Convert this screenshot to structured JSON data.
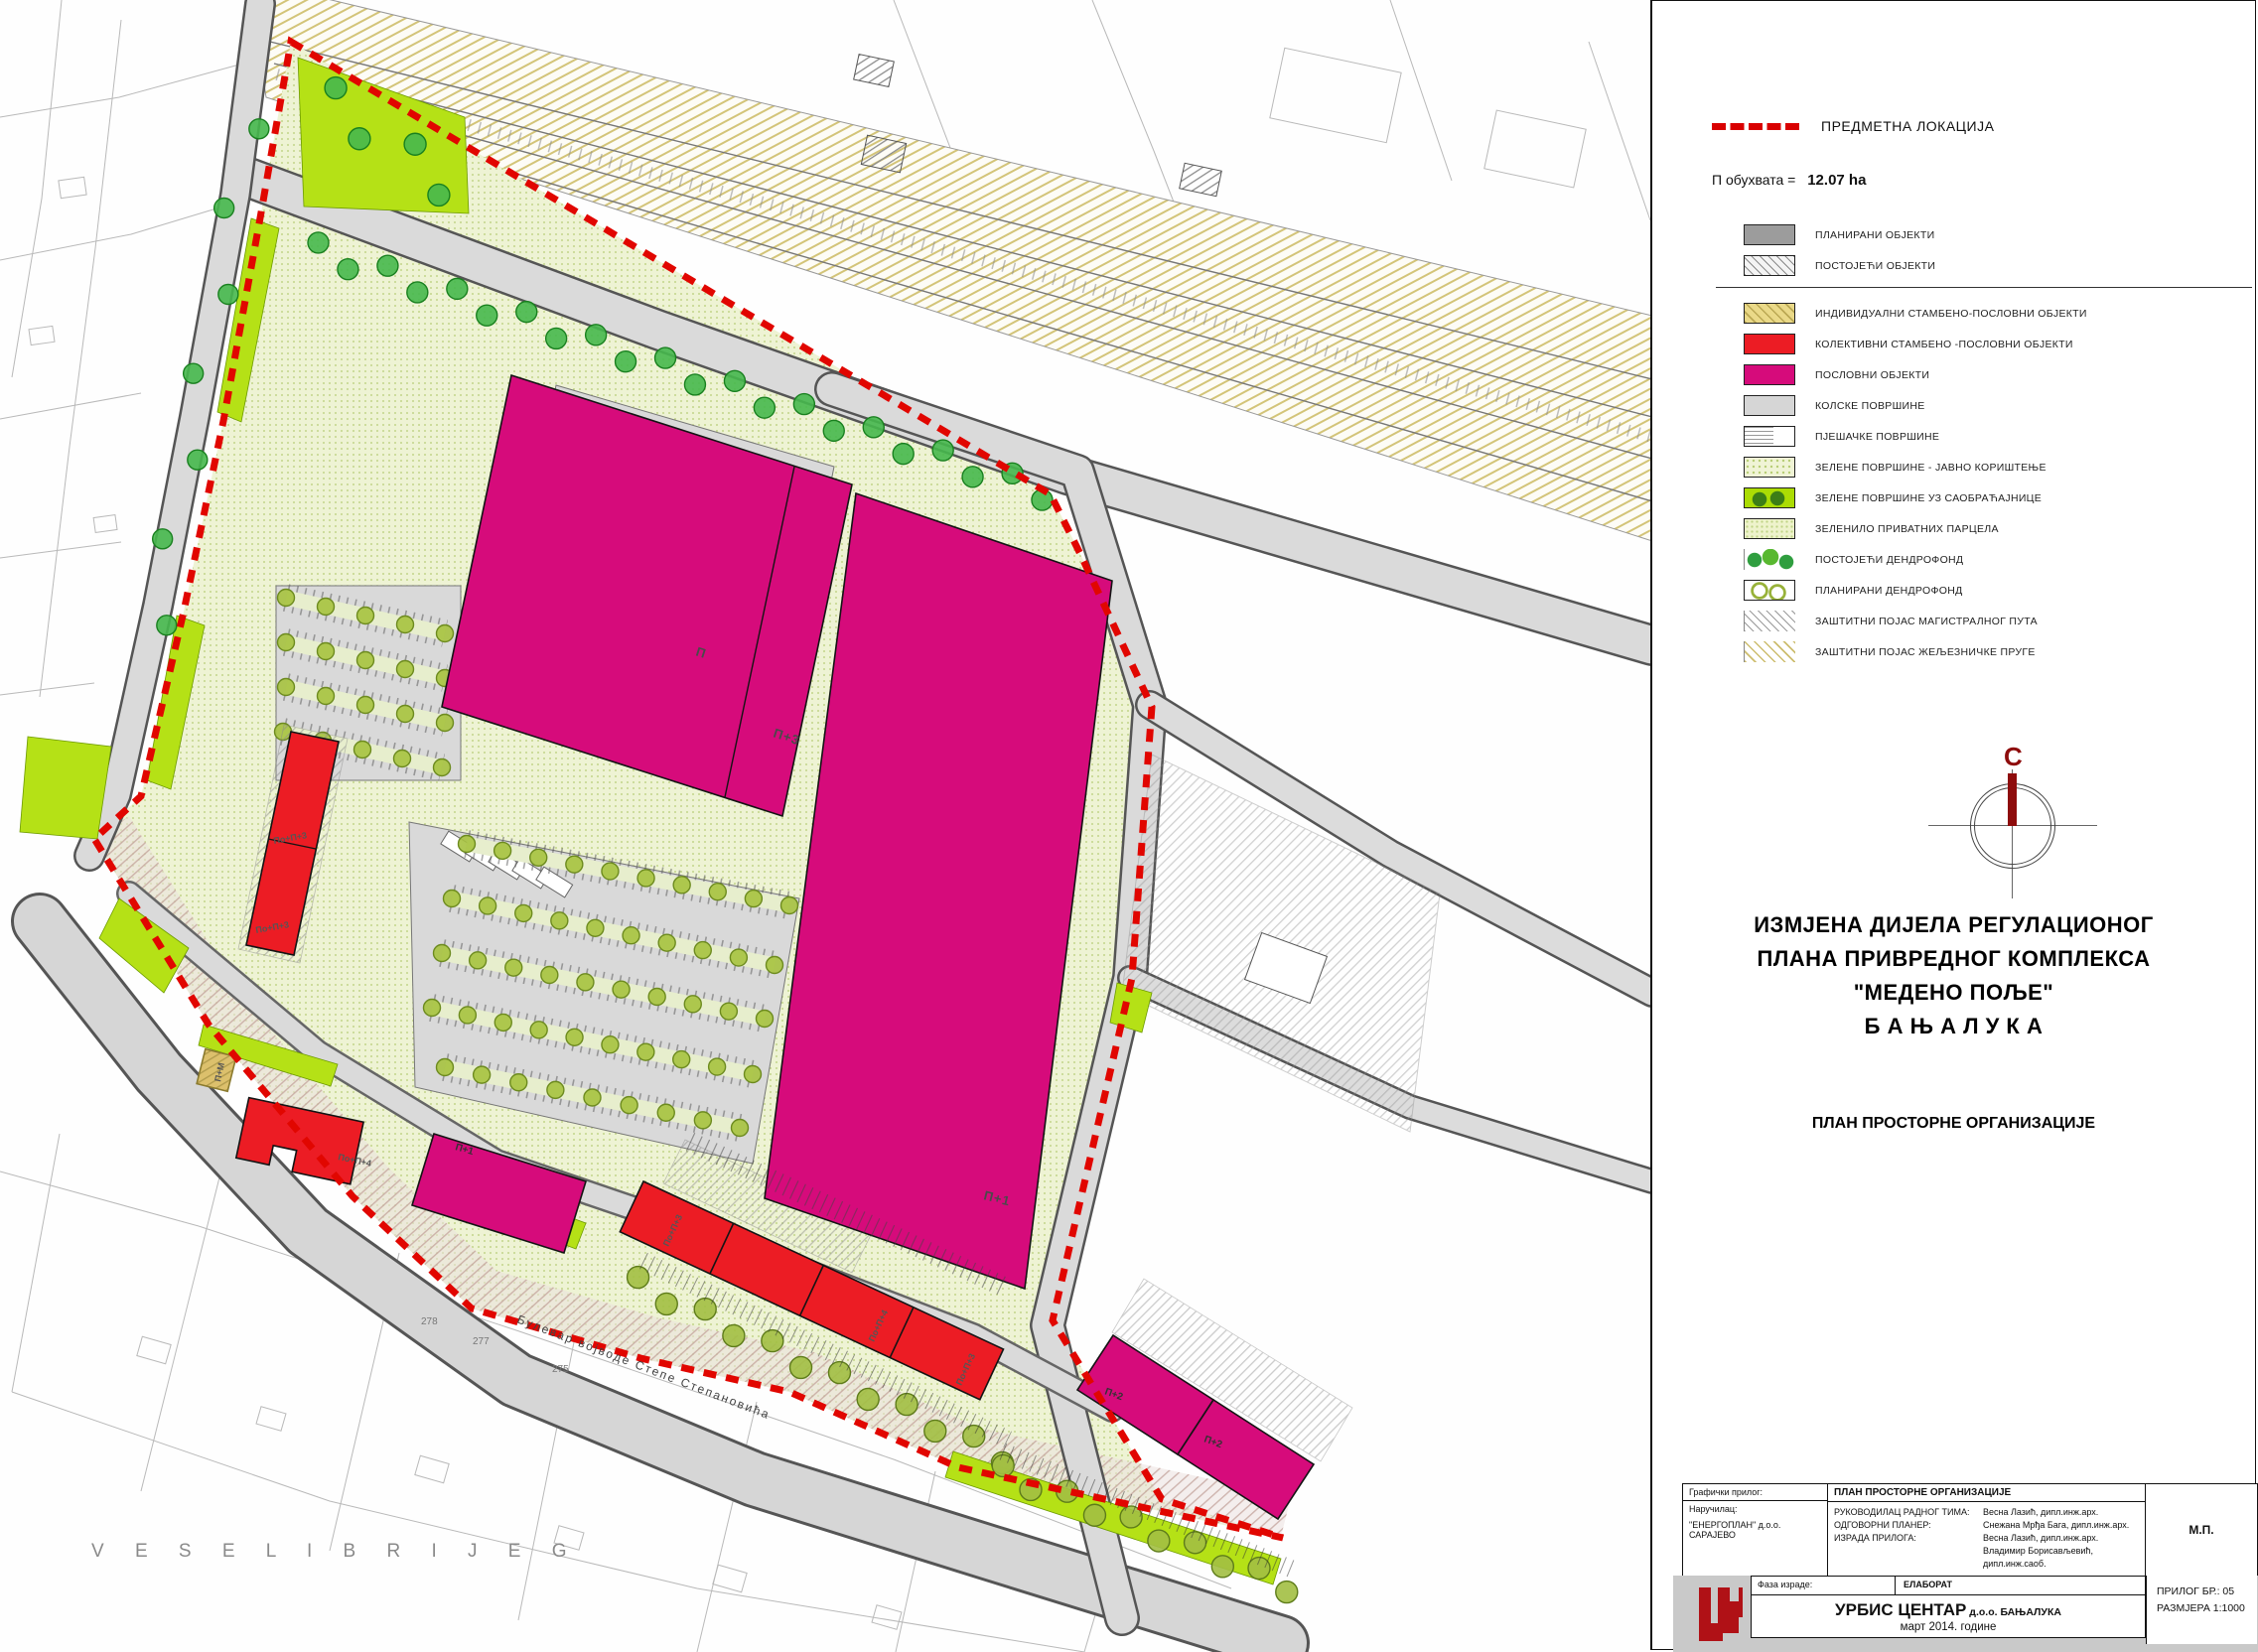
{
  "legend": {
    "location_label": "ПРЕДМЕТНА ЛОКАЦИЈА",
    "area_label": "П обухвата =",
    "area_value": "12.07 ha",
    "items": [
      {
        "key": "planned",
        "label": "ПЛАНИРАНИ ОБЈЕКТИ"
      },
      {
        "key": "existing",
        "label": "ПОСТОЈЕЋИ ОБЈЕКТИ"
      },
      {
        "key": "individual",
        "label": "ИНДИВИДУАЛНИ СТАМБЕНО-ПОСЛОВНИ ОБЈЕКТИ"
      },
      {
        "key": "collective",
        "label": "КОЛЕКТИВНИ СТАМБЕНО -ПОСЛОВНИ ОБЈЕКТИ"
      },
      {
        "key": "business",
        "label": "ПОСЛОВНИ ОБЈЕКТИ"
      },
      {
        "key": "vehicular",
        "label": "КОЛСКЕ ПОВРШИНЕ"
      },
      {
        "key": "pedestrian",
        "label": "ПЈЕШАЧКЕ ПОВРШИНЕ"
      },
      {
        "key": "green-public",
        "label": "ЗЕЛЕНЕ ПОВРШИНЕ  - ЈАВНО КОРИШТЕЊЕ"
      },
      {
        "key": "green-road",
        "label": "ЗЕЛЕНЕ ПОВРШИНЕ УЗ САОБРАЋАЈНИЦЕ"
      },
      {
        "key": "green-private",
        "label": "ЗЕЛЕНИЛО ПРИВАТНИХ ПАРЦЕЛА"
      },
      {
        "key": "dendro-existing",
        "label": "ПОСТОЈЕЋИ ДЕНДРОФОНД"
      },
      {
        "key": "dendro-planned",
        "label": "ПЛАНИРАНИ ДЕНДРОФОНД"
      },
      {
        "key": "belt-road",
        "label": "ЗАШТИТНИ ПОЈАС МАГИСТРАЛНОГ ПУТА"
      },
      {
        "key": "belt-rail",
        "label": "ЗАШТИТНИ ПОЈАС ЖЕЉЕЗНИЧКЕ ПРУГЕ"
      }
    ]
  },
  "compass": {
    "north": "С"
  },
  "titles": {
    "line1": "ИЗМЈЕНА ДИЈЕЛА РЕГУЛАЦИОНОГ",
    "line2": "ПЛАНА ПРИВРЕДНОГ КОМПЛЕКСА",
    "line3": "\"МЕДЕНО ПОЉЕ\"",
    "line4": "Б А Њ А  Л У К А",
    "subtitle": "ПЛАН ПРОСТОРНЕ ОРГАНИЗАЦИЈЕ"
  },
  "titleblock": {
    "graphic_label": "Графички прилог:",
    "plan_name": "ПЛАН ПРОСТОРНЕ ОРГАНИЗАЦИЈЕ",
    "client_label": "Наручилац:",
    "client": "\"ЕНЕРГОПЛАН\" д.о.о. САРАЈЕВО",
    "roles": [
      {
        "label": "РУКОВОДИЛАЦ РАДНОГ ТИМА:",
        "name": "Весна Лазић,  дипл.инж.арх."
      },
      {
        "label": "ОДГОВОРНИ ПЛАНЕР:",
        "name": "Снежана Мрђа Бага,  дипл.инж.арх."
      },
      {
        "label": "ИЗРАДА ПРИЛОГА:",
        "name": "Весна Лазић,  дипл.инж.арх."
      },
      {
        "label": "",
        "name": "Владимир Борисављевић,  дипл.инж.саоб."
      },
      {
        "label": "ДИРЕКТОР :",
        "name": "Снежана Мрђа Бага,  дипл.инж.арх."
      }
    ],
    "stamp": "М.П.",
    "phase_label": "Фаза израде:",
    "phase_value": "ЕЛАБОРАТ",
    "company": "УРБИС  ЦЕНТАР",
    "company_suffix": " д.о.о. БАЊАЛУКА",
    "date": "март 2014. године",
    "attachment_no": "ПРИЛОГ БР.: 05",
    "scale": "РАЗМЈЕРА 1:1000"
  },
  "map": {
    "labels": [
      {
        "text": "П"
      },
      {
        "text": "П+3"
      },
      {
        "text": "П+1"
      },
      {
        "text": "По+П+3"
      },
      {
        "text": "По+П+3"
      },
      {
        "text": "По+П+4"
      },
      {
        "text": "П+М"
      },
      {
        "text": "П+1"
      },
      {
        "text": "По+П+3"
      },
      {
        "text": "По+П+4"
      },
      {
        "text": "По+П+3"
      },
      {
        "text": "П+2"
      },
      {
        "text": "П+2"
      }
    ],
    "street": "Булевар војводе Степе Степановића",
    "district": "V E S E L I   B R I J E G",
    "parcels": [
      "278",
      "277",
      "275"
    ]
  },
  "colors": {
    "boundary": "#e10600",
    "business": "#d60b7b",
    "collective": "#ec1c24",
    "green_road": "#b5e116",
    "green_public": "#eef3d2",
    "road": "#d9d9d9",
    "rail_hatch": "#cdbd6e"
  }
}
